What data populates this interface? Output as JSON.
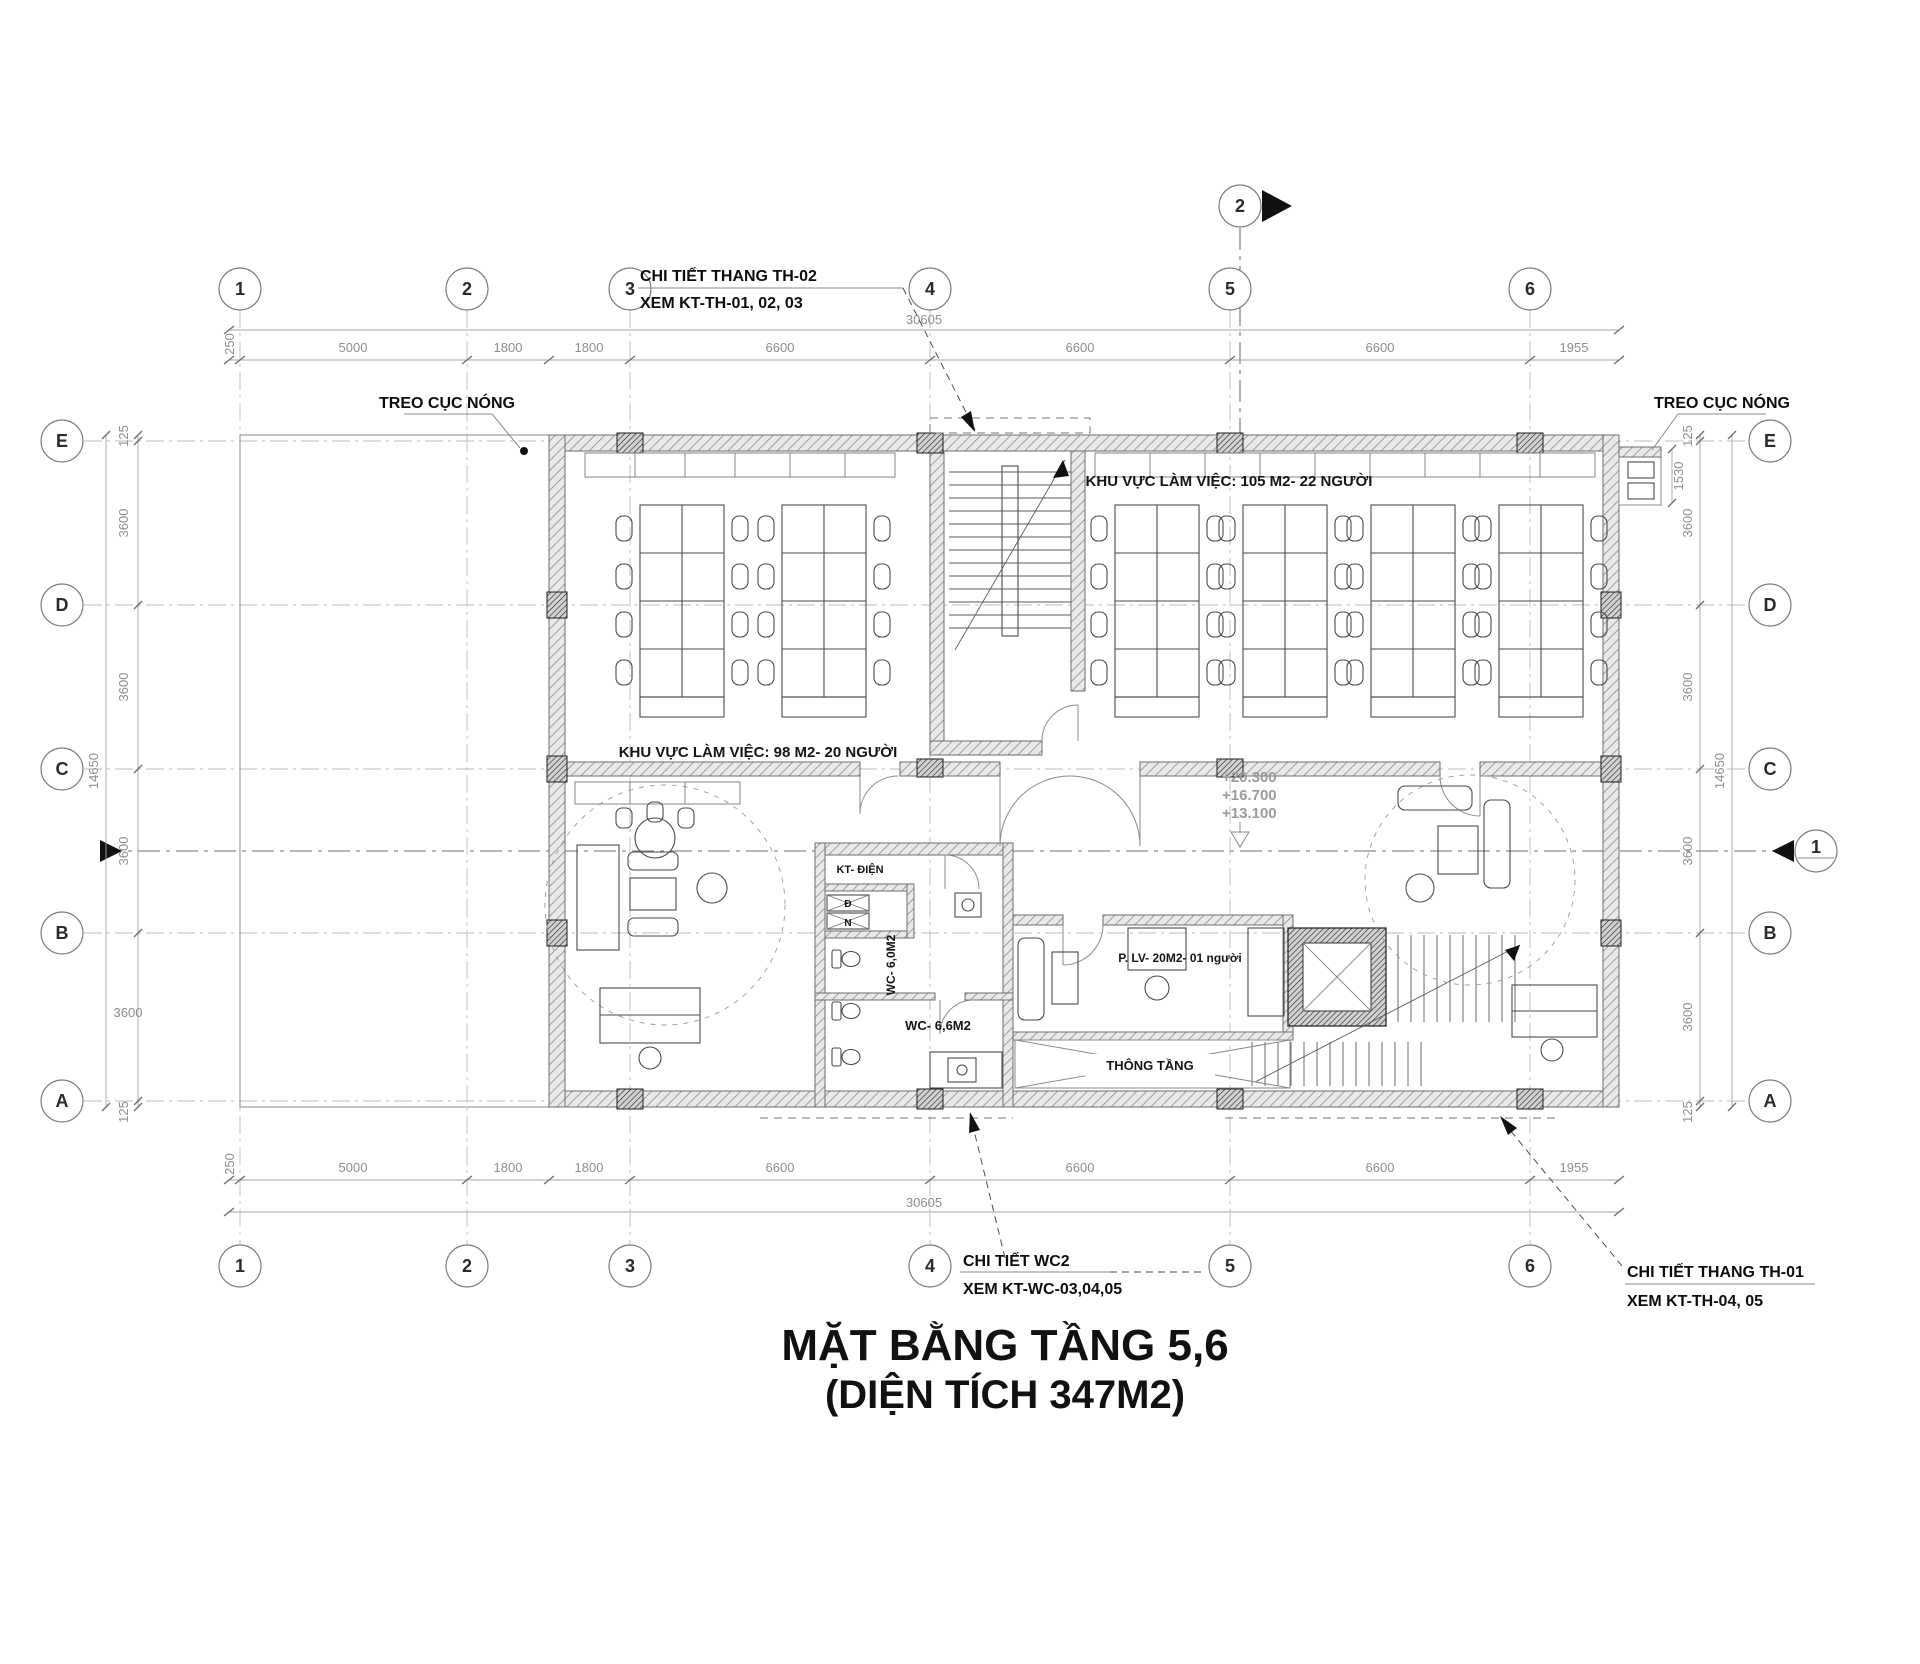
{
  "title": {
    "line1": "MẶT BẰNG TẦNG 5,6",
    "line2": "(DIỆN TÍCH 347M2)"
  },
  "callouts": {
    "th02": {
      "l1": "CHI TIẾT THANG TH-02",
      "l2": "XEM KT-TH-01, 02, 03"
    },
    "wc2": {
      "l1": "CHI TIẾT WC2",
      "l2": "XEM KT-WC-03,04,05"
    },
    "th01": {
      "l1": "CHI TIẾT THANG TH-01",
      "l2": "XEM KT-TH-04, 05"
    },
    "treo_left": "TREO CỤC NÓNG",
    "treo_right": "TREO CỤC NÓNG"
  },
  "rooms": {
    "office_left": "KHU VỰC LÀM VIỆC: 98 M2- 20 NGƯỜI",
    "office_right": "KHU VỰC LÀM VIỆC: 105 M2- 22 NGƯỜI",
    "kt_dien": "KT- ĐIỆN",
    "closet_d": "Đ",
    "closet_n": "N",
    "wc60": "WC- 6,0M2",
    "wc66": "WC- 6,6M2",
    "plv": "P. LV- 20M2- 01 người",
    "thong_tang": "THÔNG TẦNG"
  },
  "elevations": {
    "l1": "+20.300",
    "l2": "+16.700",
    "l3": "+13.100"
  },
  "grid": {
    "cols": [
      "1",
      "2",
      "3",
      "4",
      "5",
      "6"
    ],
    "rows": [
      "E",
      "D",
      "C",
      "B",
      "A"
    ]
  },
  "dims": {
    "h_total": "30605",
    "h_segs": [
      "250",
      "5000",
      "1800",
      "1800",
      "6600",
      "6600",
      "6600",
      "1955"
    ],
    "v_total": "14650",
    "v_segs": [
      "125",
      "3600",
      "3600",
      "3600",
      "3600",
      "125"
    ],
    "ledge": "1530"
  },
  "sections": {
    "s1": "1",
    "s2": "2"
  }
}
